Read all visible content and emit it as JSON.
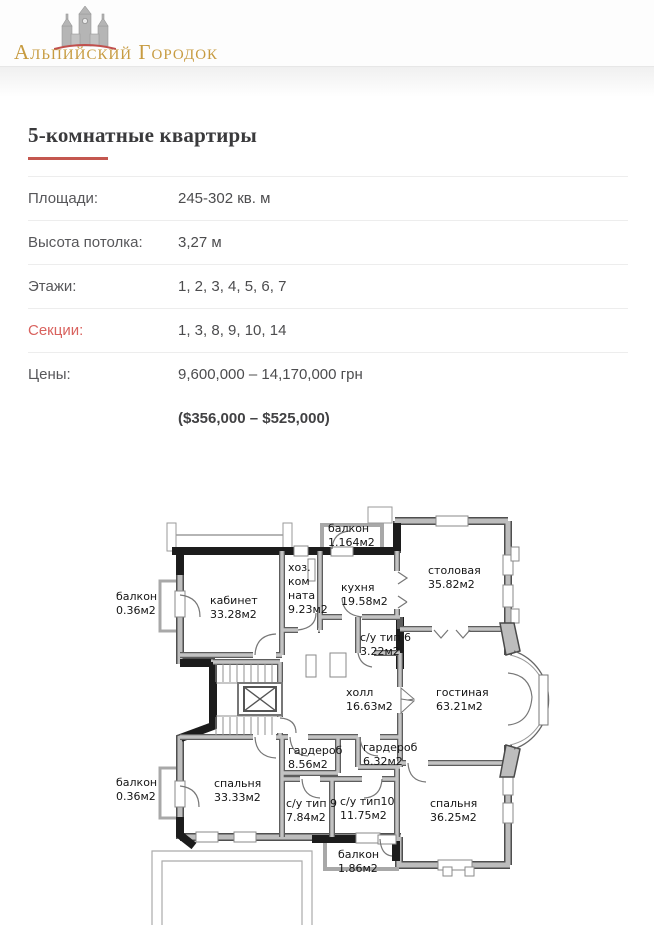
{
  "header": {
    "logo_text": "Альпийский Городок"
  },
  "content": {
    "title": "5-комнатные квартиры",
    "specs": [
      {
        "label": "Площади:",
        "value": "245-302 кв. м",
        "accent": false
      },
      {
        "label": "Высота потолка:",
        "value": "3,27 м",
        "accent": false
      },
      {
        "label": "Этажи:",
        "value": "1, 2, 3, 4, 5, 6, 7",
        "accent": false
      },
      {
        "label": "Секции:",
        "value": "1, 3, 8, 9, 10, 14",
        "accent": true
      },
      {
        "label": "Цены:",
        "value": "9,600,000 – 14,170,000 грн",
        "accent": false
      }
    ],
    "usd_price": "($356,000 – $525,000)"
  },
  "floorplan": {
    "rooms": [
      {
        "lines": [
          "балкон",
          "0.36м2"
        ],
        "x": 6,
        "y": 85
      },
      {
        "lines": [
          "кабинет",
          "33.28м2"
        ],
        "x": 100,
        "y": 89
      },
      {
        "lines": [
          "хоз.",
          "ком",
          "ната",
          "9.23м2"
        ],
        "x": 178,
        "y": 56
      },
      {
        "lines": [
          "балкон",
          "1.164м2"
        ],
        "x": 218,
        "y": 17
      },
      {
        "lines": [
          "кухня",
          "19.58м2"
        ],
        "x": 231,
        "y": 76
      },
      {
        "lines": [
          "столовая",
          "35.82м2"
        ],
        "x": 318,
        "y": 59
      },
      {
        "lines": [
          "с/у тип 6",
          "3.22м2"
        ],
        "x": 250,
        "y": 126
      },
      {
        "lines": [
          "холл",
          "16.63м2"
        ],
        "x": 236,
        "y": 181
      },
      {
        "lines": [
          "гостиная",
          "63.21м2"
        ],
        "x": 326,
        "y": 181
      },
      {
        "lines": [
          "гардероб",
          "8.56м2"
        ],
        "x": 178,
        "y": 239
      },
      {
        "lines": [
          "гардероб",
          "6.32м2"
        ],
        "x": 253,
        "y": 236
      },
      {
        "lines": [
          "балкон",
          "0.36м2"
        ],
        "x": 6,
        "y": 271
      },
      {
        "lines": [
          "спальня",
          "33.33м2"
        ],
        "x": 104,
        "y": 272
      },
      {
        "lines": [
          "с/у тип 9",
          "7.84м2"
        ],
        "x": 176,
        "y": 292
      },
      {
        "lines": [
          "с/у тип10",
          "11.75м2"
        ],
        "x": 230,
        "y": 290
      },
      {
        "lines": [
          "спальня",
          "36.25м2"
        ],
        "x": 320,
        "y": 292
      },
      {
        "lines": [
          "балкон",
          "1.86м2"
        ],
        "x": 228,
        "y": 343
      }
    ]
  },
  "colors": {
    "accent_red": "#c4574f",
    "link_red": "#d9625e",
    "logo_gold": "#c79b40",
    "wall_gray": "#bdbdbd",
    "wall_dark": "#4f4f4f",
    "wall_black": "#1c1c1c"
  }
}
